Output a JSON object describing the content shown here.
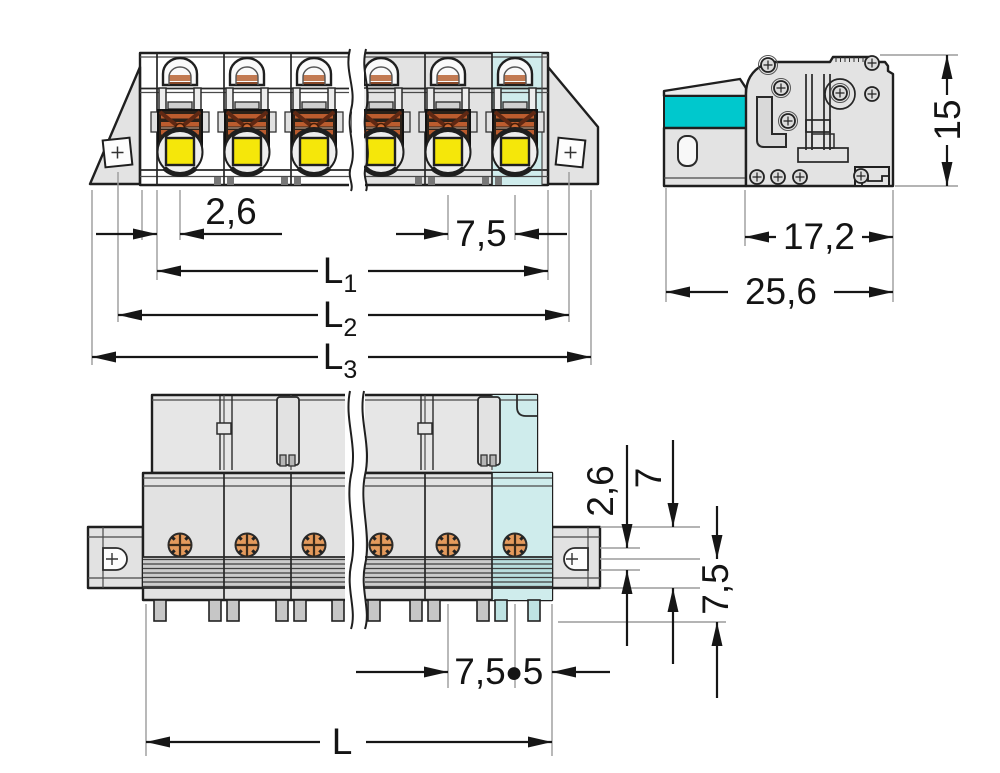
{
  "drawing": {
    "kind": "connector-dimension-drawing",
    "colors": {
      "background": "#ffffff",
      "body_gray": "#e3e3e3",
      "outline": "#1f1f1f",
      "highlight_pole": "#cfecec",
      "lever_cyan": "#00c8cd",
      "contact_yellow": "#f5e70a",
      "clamp_orange": "#bb5c2e",
      "screw_orange": "#e49a5c",
      "extension_line": "#9b9b9b"
    }
  },
  "front_view": {
    "dims": {
      "pin_offset": "2,6",
      "pitch": "7,5",
      "l1_base": "L",
      "l1_sub": "1",
      "l2_base": "L",
      "l2_sub": "2",
      "l3_base": "L",
      "l3_sub": "3"
    }
  },
  "side_view": {
    "dims": {
      "height": "15",
      "body_depth": "17,2",
      "total_depth": "25,6"
    }
  },
  "bottom_view": {
    "dims": {
      "flange_offset": "2,6",
      "flange_width": "7",
      "row_pitch": "7,5",
      "pitch": "7,5",
      "separator": "●",
      "end_offset": "5",
      "length": "L"
    }
  }
}
